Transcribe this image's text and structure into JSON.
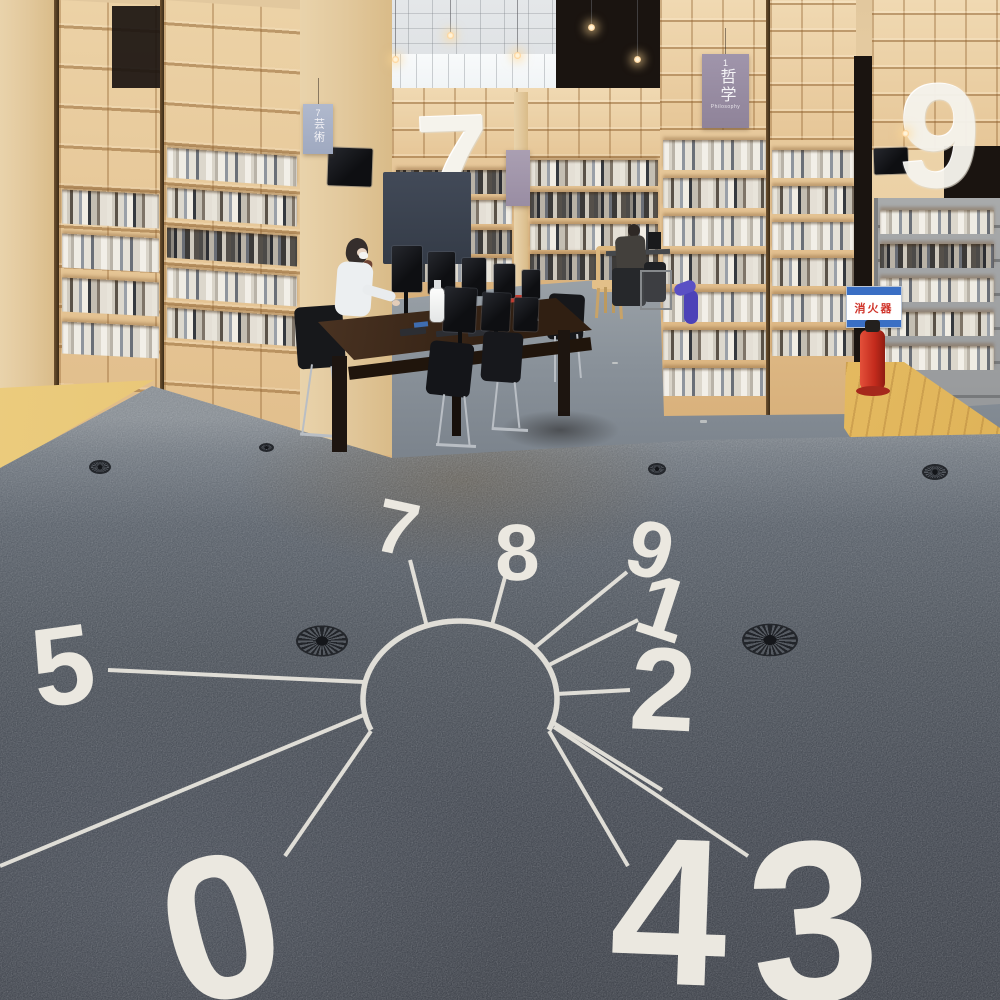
{
  "scene": {
    "description": "Library reading room with tall plywood bookshelves, a computer reading table, hanging category banners and numeral sculptures, and a dark carpet printed with a giant keyhole wayfinding diagram whose lines radiate to large classification numerals."
  },
  "banners": {
    "art": {
      "index": "7",
      "title": "芸術"
    },
    "philosophy": {
      "index": "1",
      "title": "哲学",
      "subtitle": "Philosophy"
    }
  },
  "sculptures": {
    "left_numeral": "7",
    "right_numeral": "9"
  },
  "safety": {
    "fire_extinguisher_sign": "消火器"
  },
  "floor_numbers": {
    "n0": "0",
    "n1": "1",
    "n2": "2",
    "n3": "3",
    "n4": "4",
    "n5": "5",
    "n7": "7",
    "n8": "8",
    "n9": "9"
  },
  "colors": {
    "carpet": "#4b515a",
    "carpet_far": "#8a929a",
    "floor_marking": "#ebe8e0",
    "plywood": "#e6c795",
    "wood_floor": "#e9c06a",
    "banner_art": "#a9b2c8",
    "banner_philosophy": "#9c8fa6",
    "extinguisher_red": "#d0342a",
    "sign_blue": "#3a6fc4"
  }
}
